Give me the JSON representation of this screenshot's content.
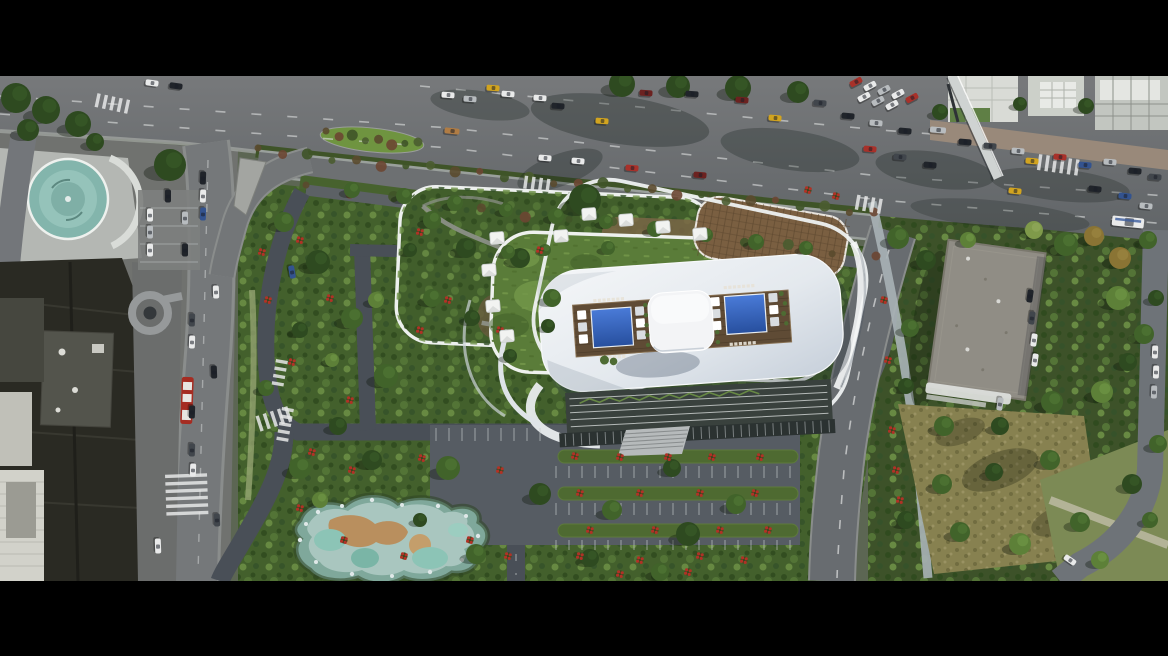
{
  "scene": {
    "description": "Letterboxed aerial drone rendering of a waterfront mixed-use development: a white sculpted tower roof with twin blue swimming pools, wooden pool deck and central pavilion, stacked rounded garden terraces with white canopies, flowering gardens, a rock-edged pond, parking courts, a busy multi-lane boulevard with traffic, older city blocks at left and a tree-filled block with a flat-roofed building at right.",
    "letterbox": {
      "top_height": 76,
      "bottom_height": 75
    }
  },
  "palette": {
    "bar": "#000000",
    "roadMain": "#6f7274",
    "roadDark": "#5e6265",
    "roadService": "#6d7072",
    "roadSite": "#494f57",
    "roadRight": "#686c70",
    "curb": "#9aa09c",
    "plaza": "#b4b7b3",
    "sidewalkBrick": "#99897a",
    "vegBase": "#43602c",
    "lawn": "#5a7c39",
    "dry": "#878150",
    "flowerRed": "#b03226",
    "roofWhite": "#eef0f3",
    "roofShade": "#c6cfda",
    "deck": "#5f4b35",
    "pool": "#2f62b8",
    "pavilion": "#f3f4f6",
    "teal": "#83b5ac",
    "pond": "#a9c6bf",
    "sand": "#b98f5e",
    "bldDark": "#2a2a23",
    "bldGray": "#53544c",
    "bldLight": "#d2d2ca",
    "roofGray": "#908d85",
    "trellis": "#7a5f41",
    "rim": "#eef1ee"
  },
  "carColors": {
    "white": "#e9eaea",
    "silver": "#b8bcbf",
    "black": "#20242a",
    "darkgray": "#41464c",
    "red": "#a8312a",
    "maroon": "#6c2220",
    "yellow": "#d2a41f",
    "blue": "#33538f",
    "tan": "#b07c44"
  },
  "cars": [
    [
      448,
      95,
      4,
      "white"
    ],
    [
      470,
      99,
      4,
      "silver"
    ],
    [
      493,
      88,
      4,
      "yellow"
    ],
    [
      540,
      98,
      4,
      "white"
    ],
    [
      558,
      106,
      4,
      "black"
    ],
    [
      602,
      121,
      4,
      "yellow"
    ],
    [
      646,
      93,
      4,
      "maroon"
    ],
    [
      692,
      94,
      4,
      "black"
    ],
    [
      742,
      100,
      5,
      "maroon"
    ],
    [
      775,
      118,
      5,
      "yellow"
    ],
    [
      820,
      103,
      5,
      "darkgray"
    ],
    [
      848,
      116,
      5,
      "black"
    ],
    [
      876,
      123,
      5,
      "silver"
    ],
    [
      905,
      131,
      5,
      "black"
    ],
    [
      938,
      130,
      5,
      "silver",
      16
    ],
    [
      965,
      142,
      5,
      "black"
    ],
    [
      990,
      146,
      5,
      "darkgray"
    ],
    [
      1018,
      151,
      5,
      "silver"
    ],
    [
      1032,
      161,
      5,
      "yellow"
    ],
    [
      1060,
      157,
      5,
      "red"
    ],
    [
      1085,
      165,
      5,
      "blue"
    ],
    [
      1110,
      162,
      5,
      "silver"
    ],
    [
      1135,
      171,
      5,
      "black"
    ],
    [
      1155,
      177,
      5,
      "darkgray"
    ],
    [
      870,
      149,
      5,
      "red"
    ],
    [
      900,
      157,
      5,
      "darkgray"
    ],
    [
      930,
      165,
      5,
      "black"
    ],
    [
      1095,
      189,
      6,
      "black"
    ],
    [
      1125,
      196,
      6,
      "blue"
    ],
    [
      508,
      94,
      4,
      "white"
    ],
    [
      452,
      131,
      6,
      "tan",
      15
    ],
    [
      545,
      158,
      5,
      "white"
    ],
    [
      578,
      161,
      5,
      "white"
    ],
    [
      632,
      168,
      5,
      "red"
    ],
    [
      700,
      175,
      5,
      "maroon"
    ],
    [
      1015,
      191,
      6,
      "yellow"
    ],
    [
      1146,
      206,
      6,
      "silver"
    ],
    [
      856,
      82,
      -28,
      "red"
    ],
    [
      870,
      86,
      -28,
      "white"
    ],
    [
      884,
      90,
      -28,
      "silver"
    ],
    [
      898,
      94,
      -28,
      "white"
    ],
    [
      912,
      98,
      -28,
      "red"
    ],
    [
      864,
      97,
      -28,
      "white"
    ],
    [
      878,
      101,
      -28,
      "silver"
    ],
    [
      892,
      105,
      -28,
      "white"
    ],
    [
      1128,
      222,
      6,
      "white",
      32
    ],
    [
      152,
      83,
      8,
      "white"
    ],
    [
      176,
      86,
      8,
      "black"
    ],
    [
      203,
      178,
      92,
      "black"
    ],
    [
      203,
      196,
      92,
      "white"
    ],
    [
      203,
      214,
      92,
      "blue"
    ],
    [
      192,
      320,
      92,
      "darkgray"
    ],
    [
      192,
      342,
      92,
      "white"
    ],
    [
      192,
      412,
      92,
      "black"
    ],
    [
      192,
      450,
      92,
      "darkgray"
    ],
    [
      193,
      470,
      92,
      "white"
    ],
    [
      216,
      292,
      88,
      "white"
    ],
    [
      214,
      372,
      88,
      "black"
    ],
    [
      217,
      520,
      88,
      "darkgray"
    ],
    [
      158,
      546,
      88,
      "white",
      15
    ],
    [
      292,
      272,
      80,
      "blue"
    ],
    [
      150,
      215,
      90,
      "white"
    ],
    [
      150,
      232,
      90,
      "silver"
    ],
    [
      150,
      250,
      90,
      "white"
    ],
    [
      185,
      218,
      90,
      "silver"
    ],
    [
      185,
      250,
      90,
      "black"
    ],
    [
      168,
      196,
      90,
      "black"
    ],
    [
      1030,
      296,
      98,
      "black"
    ],
    [
      1032,
      318,
      98,
      "darkgray"
    ],
    [
      1034,
      340,
      98,
      "white"
    ],
    [
      1035,
      360,
      98,
      "white"
    ],
    [
      1000,
      404,
      98,
      "silver"
    ],
    [
      1155,
      352,
      92,
      "white"
    ],
    [
      1156,
      372,
      92,
      "white"
    ],
    [
      1154,
      392,
      92,
      "silver"
    ],
    [
      1070,
      560,
      35,
      "white"
    ]
  ],
  "treePalette": [
    "#2e4a20",
    "#41632a",
    "#5d8038",
    "#7f9a4a",
    "#8a7434"
  ],
  "treePaletteLight": [
    "#3c5e2a",
    "#547c36",
    "#739a48",
    "#95ad5e",
    "#a08a45"
  ],
  "trees": [
    [
      16,
      98,
      15,
      0
    ],
    [
      46,
      110,
      14,
      0
    ],
    [
      78,
      124,
      13,
      0
    ],
    [
      28,
      130,
      11,
      0
    ],
    [
      95,
      142,
      9,
      0
    ],
    [
      170,
      165,
      16,
      0
    ],
    [
      622,
      84,
      13,
      0
    ],
    [
      678,
      86,
      12,
      0
    ],
    [
      738,
      88,
      13,
      0
    ],
    [
      798,
      92,
      11,
      0
    ],
    [
      585,
      200,
      16,
      0
    ],
    [
      352,
      190,
      8,
      1
    ],
    [
      404,
      196,
      8,
      1
    ],
    [
      455,
      203,
      8,
      1
    ],
    [
      506,
      210,
      7,
      1
    ],
    [
      556,
      216,
      8,
      1
    ],
    [
      606,
      222,
      7,
      1
    ],
    [
      655,
      229,
      8,
      1
    ],
    [
      706,
      235,
      7,
      1
    ],
    [
      756,
      242,
      8,
      1
    ],
    [
      806,
      248,
      7,
      1
    ],
    [
      284,
      222,
      10,
      1
    ],
    [
      318,
      262,
      12,
      0
    ],
    [
      352,
      318,
      11,
      1
    ],
    [
      300,
      330,
      8,
      0
    ],
    [
      386,
      376,
      12,
      1
    ],
    [
      338,
      426,
      9,
      0
    ],
    [
      266,
      388,
      8,
      1
    ],
    [
      376,
      300,
      8,
      2
    ],
    [
      332,
      360,
      7,
      2
    ],
    [
      432,
      220,
      9,
      1
    ],
    [
      466,
      248,
      10,
      0
    ],
    [
      432,
      298,
      9,
      1
    ],
    [
      520,
      258,
      10,
      0
    ],
    [
      552,
      298,
      9,
      1
    ],
    [
      472,
      318,
      8,
      0
    ],
    [
      608,
      248,
      7,
      1
    ],
    [
      410,
      250,
      7,
      0
    ],
    [
      548,
      326,
      7,
      0
    ],
    [
      508,
      252,
      7,
      1
    ],
    [
      510,
      356,
      7,
      0
    ],
    [
      545,
      250,
      6,
      1
    ],
    [
      300,
      468,
      11,
      1
    ],
    [
      372,
      460,
      10,
      0
    ],
    [
      448,
      468,
      12,
      1
    ],
    [
      540,
      494,
      11,
      0
    ],
    [
      612,
      510,
      10,
      1
    ],
    [
      688,
      534,
      12,
      0
    ],
    [
      476,
      554,
      10,
      1
    ],
    [
      672,
      468,
      9,
      0
    ],
    [
      736,
      504,
      10,
      1
    ],
    [
      590,
      558,
      9,
      0
    ],
    [
      320,
      500,
      8,
      2
    ],
    [
      420,
      520,
      7,
      0
    ],
    [
      660,
      572,
      9,
      1
    ],
    [
      898,
      238,
      11,
      1
    ],
    [
      926,
      260,
      10,
      0
    ],
    [
      910,
      328,
      9,
      1
    ],
    [
      906,
      386,
      8,
      0
    ],
    [
      944,
      426,
      10,
      1
    ],
    [
      1000,
      426,
      9,
      0
    ],
    [
      1052,
      402,
      11,
      1
    ],
    [
      1066,
      244,
      12,
      1
    ],
    [
      1094,
      236,
      10,
      4
    ],
    [
      1120,
      258,
      11,
      4
    ],
    [
      1148,
      240,
      9,
      1
    ],
    [
      1118,
      298,
      12,
      2
    ],
    [
      1144,
      334,
      10,
      1
    ],
    [
      1102,
      392,
      11,
      2
    ],
    [
      1050,
      460,
      10,
      1
    ],
    [
      994,
      472,
      9,
      0
    ],
    [
      942,
      484,
      10,
      1
    ],
    [
      906,
      520,
      9,
      0
    ],
    [
      960,
      532,
      10,
      1
    ],
    [
      1020,
      544,
      11,
      2
    ],
    [
      1080,
      522,
      10,
      1
    ],
    [
      1132,
      484,
      10,
      0
    ],
    [
      1158,
      444,
      9,
      1
    ],
    [
      1156,
      298,
      8,
      0
    ],
    [
      1128,
      362,
      9,
      0
    ],
    [
      1034,
      230,
      9,
      3
    ],
    [
      968,
      240,
      8,
      2
    ],
    [
      940,
      112,
      8,
      0
    ],
    [
      1020,
      104,
      7,
      0
    ],
    [
      1086,
      106,
      8,
      0
    ],
    [
      1100,
      560,
      9,
      2
    ],
    [
      1150,
      520,
      8,
      1
    ]
  ],
  "flowers": [
    [
      300,
      240
    ],
    [
      330,
      298
    ],
    [
      292,
      362
    ],
    [
      350,
      400
    ],
    [
      268,
      300
    ],
    [
      262,
      252
    ],
    [
      312,
      452
    ],
    [
      352,
      470
    ],
    [
      422,
      458
    ],
    [
      500,
      470
    ],
    [
      580,
      556
    ],
    [
      640,
      560
    ],
    [
      700,
      556
    ],
    [
      744,
      560
    ],
    [
      300,
      508
    ],
    [
      344,
      540
    ],
    [
      404,
      556
    ],
    [
      470,
      540
    ],
    [
      508,
      556
    ],
    [
      688,
      572
    ],
    [
      620,
      574
    ],
    [
      575,
      456
    ],
    [
      620,
      457
    ],
    [
      668,
      457
    ],
    [
      712,
      457
    ],
    [
      760,
      457
    ],
    [
      580,
      493
    ],
    [
      640,
      493
    ],
    [
      700,
      493
    ],
    [
      755,
      493
    ],
    [
      590,
      530
    ],
    [
      655,
      530
    ],
    [
      720,
      530
    ],
    [
      768,
      530
    ],
    [
      420,
      232
    ],
    [
      448,
      300
    ],
    [
      420,
      330
    ],
    [
      500,
      330
    ],
    [
      540,
      250
    ],
    [
      884,
      300
    ],
    [
      888,
      360
    ],
    [
      892,
      430
    ],
    [
      896,
      470
    ],
    [
      900,
      500
    ],
    [
      808,
      190
    ],
    [
      836,
      196
    ]
  ],
  "canopies": [
    [
      497,
      238
    ],
    [
      489,
      270
    ],
    [
      493,
      306
    ],
    [
      507,
      336
    ],
    [
      589,
      214
    ],
    [
      626,
      220
    ],
    [
      663,
      227
    ],
    [
      700,
      234
    ],
    [
      561,
      236
    ]
  ],
  "crosswalks": [
    {
      "x": 96,
      "y": 100,
      "rot": 12,
      "n": 5,
      "len": 14
    },
    {
      "x": 1038,
      "y": 162,
      "rot": 8,
      "n": 6,
      "len": 16
    },
    {
      "x": 186,
      "y": 474,
      "rot": 88,
      "n": 6,
      "len": 42
    },
    {
      "x": 258,
      "y": 424,
      "rot": -18,
      "n": 5,
      "len": 16
    },
    {
      "x": 524,
      "y": 182,
      "rot": 8,
      "n": 4,
      "len": 13
    },
    {
      "x": 856,
      "y": 202,
      "rot": 10,
      "n": 4,
      "len": 15
    },
    {
      "x": 282,
      "y": 360,
      "rot": 100,
      "n": 4,
      "len": 12
    },
    {
      "x": 288,
      "y": 408,
      "rot": 100,
      "n": 5,
      "len": 12
    }
  ],
  "bushRows": [
    {
      "x1": 258,
      "y1": 151,
      "x2": 874,
      "y2": 213,
      "n": 26
    },
    {
      "x1": 326,
      "y1": 134,
      "x2": 418,
      "y2": 145,
      "n": 8
    },
    {
      "x1": 306,
      "y1": 188,
      "x2": 876,
      "y2": 256,
      "n": 14
    }
  ],
  "tickRows": [
    {
      "x1": 436,
      "x2": 548,
      "y": 428,
      "len": 13
    },
    {
      "x1": 556,
      "x2": 796,
      "y": 466,
      "len": 12
    },
    {
      "x1": 556,
      "x2": 796,
      "y": 503,
      "len": 12
    },
    {
      "x1": 556,
      "x2": 796,
      "y": 540,
      "len": 10
    }
  ]
}
